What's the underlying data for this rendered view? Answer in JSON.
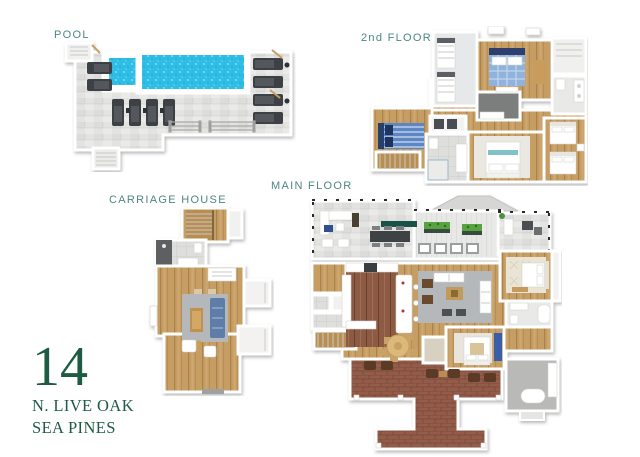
{
  "page": {
    "width": 640,
    "height": 457,
    "background": "#ffffff",
    "description": "3D floor plan marketing sheet for a vacation rental home"
  },
  "labels": {
    "pool": "POOL",
    "second_floor": "2nd FLOOR",
    "carriage_house": "CARRIAGE HOUSE",
    "main_floor": "MAIN FLOOR"
  },
  "address": {
    "number": "14",
    "street": "N. LIVE OAK",
    "community": "SEA PINES"
  },
  "colors": {
    "label_teal": "#4d8781",
    "address_green": "#1e5b43",
    "pool_water": "#2fbde4",
    "wood_floor": "#c69d63",
    "kitchen_wood": "#8d5a43",
    "tile_grey": "#dededc",
    "stone_deck": "#e3e3e1",
    "rug_grey": "#b4b8ba",
    "brick_patio": "#935c48",
    "sofa_blue": "#5e7da9",
    "plant_green": "#57a33f",
    "dark_furniture": "#3d4145"
  },
  "plans": {
    "pool": {
      "label": "POOL",
      "features": [
        "rectangular swimming pool",
        "square spa",
        "stone paver deck",
        "ten chaise lounge chairs",
        "entry steps",
        "stair railings"
      ]
    },
    "second_floor": {
      "label": "2nd FLOOR",
      "features": [
        "bunk room",
        "bedroom with blue plaid bed",
        "bedroom with blue striped bed",
        "bedroom with two beds",
        "bedroom with white bed",
        "two bathrooms",
        "dark tile shower bath",
        "laundry",
        "staircase"
      ]
    },
    "carriage_house": {
      "label": "CARRIAGE HOUSE",
      "features": [
        "staircase",
        "bathroom with shower",
        "living room with blue sofa and grey rug",
        "wood coffee table",
        "two white armchairs",
        "side alcoves"
      ]
    },
    "main_floor": {
      "label": "MAIN FLOOR",
      "features": [
        "screened porch with dining table",
        "deck with planters",
        "side porch",
        "kitchen with island",
        "great room with grey rug and white sofas",
        "round breakfast table",
        "master bedroom",
        "guest bedroom with blue bench",
        "brick patio with rocking chairs",
        "walkway",
        "garage"
      ]
    }
  }
}
